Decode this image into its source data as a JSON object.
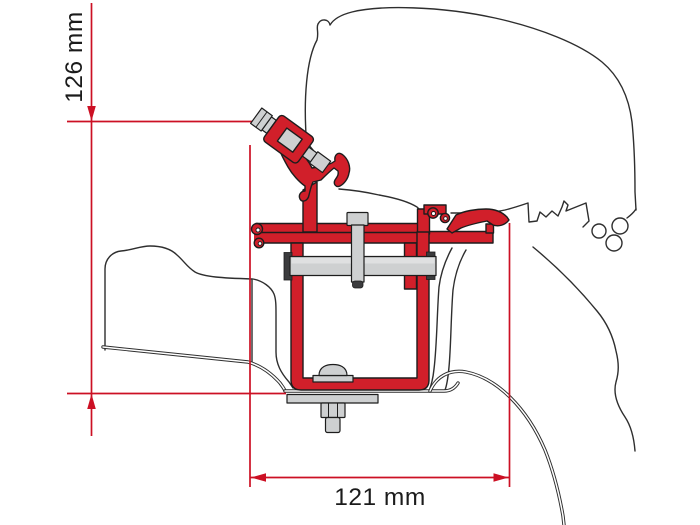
{
  "drawing": {
    "dimension_vertical": {
      "label": "126 mm",
      "orientation": "vertical"
    },
    "dimension_horizontal": {
      "label": "121 mm",
      "orientation": "horizontal"
    },
    "colors": {
      "dimension_line": "#cc1024",
      "bracket_red": "#d11f2a",
      "metal_gray": "#ced0d1",
      "dark_metal": "#3b3b3d",
      "vehicle_outline": "#2e2e2e",
      "background": "#ffffff"
    }
  }
}
